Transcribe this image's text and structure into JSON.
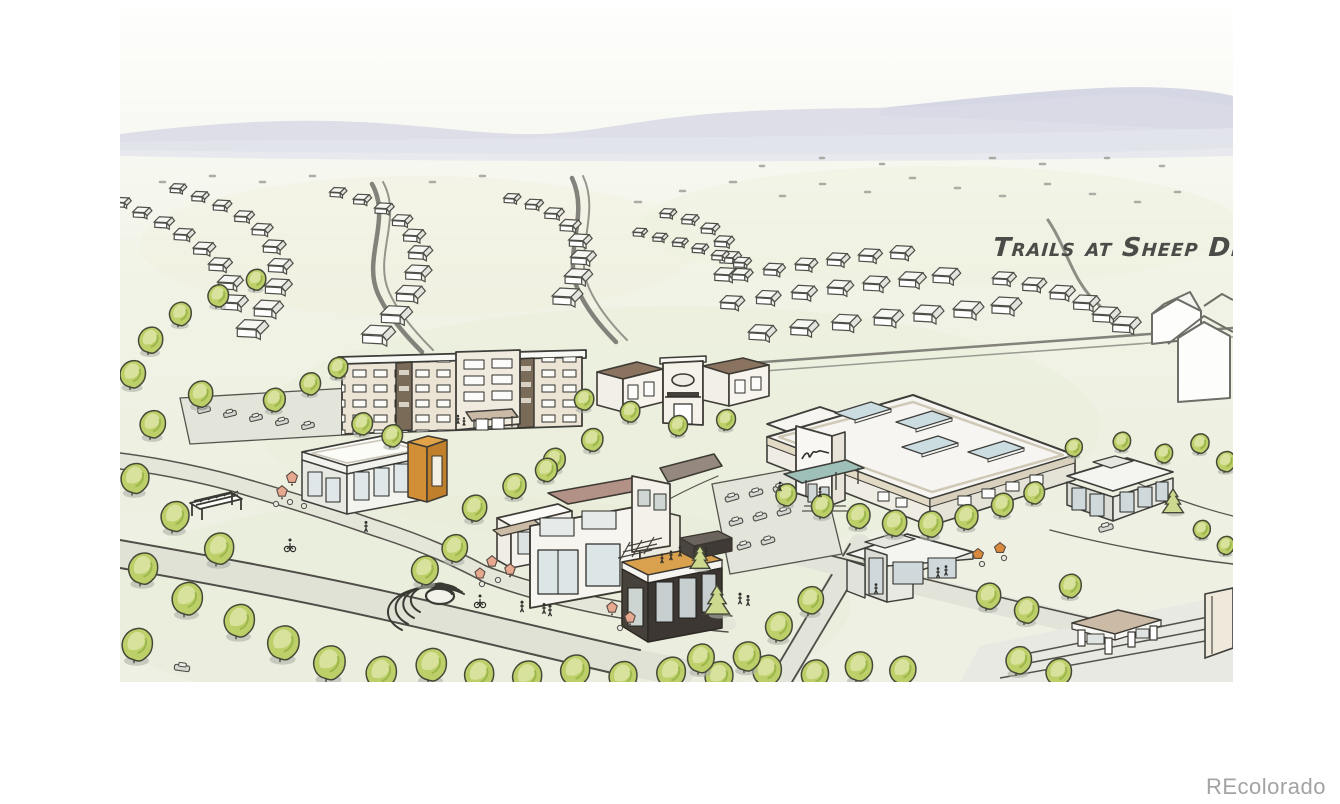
{
  "scene": {
    "title_label": "Trails at Sheep Dr",
    "watermark": "REcolorado"
  },
  "palette": {
    "field_green": "#edf0e1",
    "mountain_lavender": "#d9dae6",
    "tree_green": "#bccf68",
    "tree_green_light": "#dce3a2",
    "accent_orange": "#d28f35",
    "deck_tan": "#d9a14e",
    "canopy_teal": "#9fc0b8",
    "roof_brown": "#b29186",
    "umbrella_salmon": "#e6a88e",
    "sketch_ink": "#4a4a44",
    "watermark_gray": "#a3a3a3"
  }
}
